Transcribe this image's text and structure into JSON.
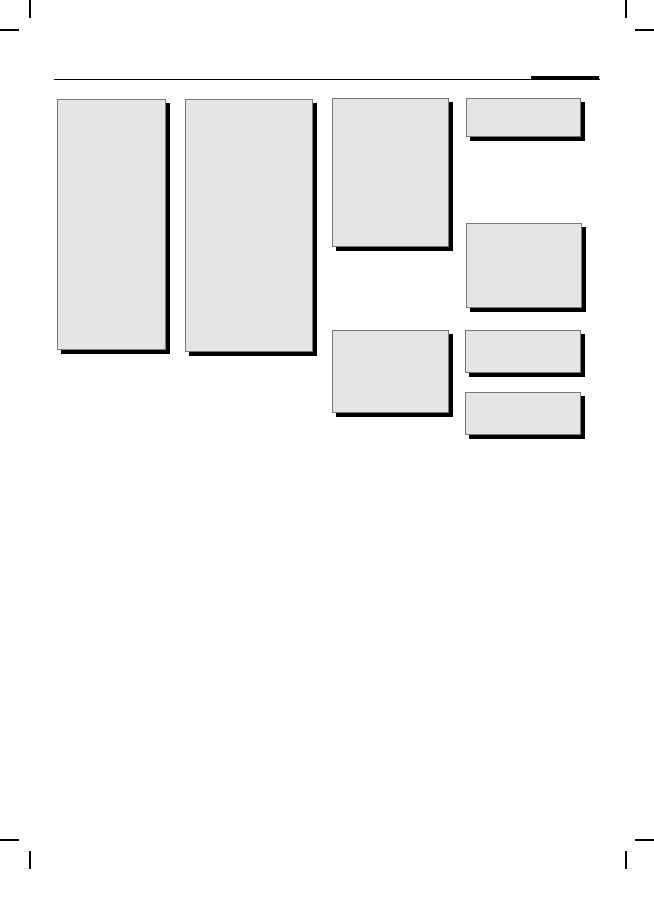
{
  "canvas": {
    "width": 654,
    "height": 916,
    "background": "#ffffff"
  },
  "visible_text": [],
  "colors": {
    "background": "#ffffff",
    "placeholder_fill": "#e4e4e4",
    "placeholder_border": "#7a7a7a",
    "shadow": "#000000",
    "line": "#000000"
  },
  "header": {
    "rule": {
      "x": 54,
      "y": 78.8,
      "width": 546,
      "height": 1.6
    },
    "masthead_bar": {
      "x": 531,
      "y": 76.4,
      "width": 68,
      "height": 4
    }
  },
  "crop_marks": [
    {
      "name": "crop-mark-top-left-vertical",
      "x": 28.5,
      "y": 0,
      "width": 2,
      "height": 18
    },
    {
      "name": "crop-mark-top-left-horizontal",
      "x": 0,
      "y": 28.5,
      "width": 19,
      "height": 2
    },
    {
      "name": "crop-mark-top-right-vertical",
      "x": 624.5,
      "y": 0,
      "width": 2,
      "height": 18
    },
    {
      "name": "crop-mark-top-right-horizontal",
      "x": 635,
      "y": 28.5,
      "width": 19,
      "height": 2
    },
    {
      "name": "crop-mark-bottom-left-horizontal",
      "x": 0,
      "y": 838.5,
      "width": 19,
      "height": 2
    },
    {
      "name": "crop-mark-bottom-left-vertical",
      "x": 28.5,
      "y": 851,
      "width": 2,
      "height": 18
    },
    {
      "name": "crop-mark-bottom-right-horizontal",
      "x": 635,
      "y": 838.5,
      "width": 19,
      "height": 2
    },
    {
      "name": "crop-mark-bottom-right-vertical",
      "x": 624.5,
      "y": 851,
      "width": 2,
      "height": 18
    }
  ],
  "placeholder_blocks": [
    {
      "name": "article-block-column-1",
      "x": 57,
      "y": 99,
      "width": 109,
      "height": 251
    },
    {
      "name": "article-block-column-2",
      "x": 185,
      "y": 99,
      "width": 128,
      "height": 253
    },
    {
      "name": "article-block-column-3-top",
      "x": 332,
      "y": 98,
      "width": 117,
      "height": 149
    },
    {
      "name": "article-block-column-3-bottom",
      "x": 332,
      "y": 330,
      "width": 117,
      "height": 83
    },
    {
      "name": "sidebar-block-1",
      "x": 466,
      "y": 98,
      "width": 115,
      "height": 39
    },
    {
      "name": "sidebar-block-2",
      "x": 466,
      "y": 223,
      "width": 116,
      "height": 85
    },
    {
      "name": "sidebar-block-3",
      "x": 465,
      "y": 330,
      "width": 116,
      "height": 43
    },
    {
      "name": "sidebar-block-4",
      "x": 465,
      "y": 392,
      "width": 116,
      "height": 43
    }
  ]
}
